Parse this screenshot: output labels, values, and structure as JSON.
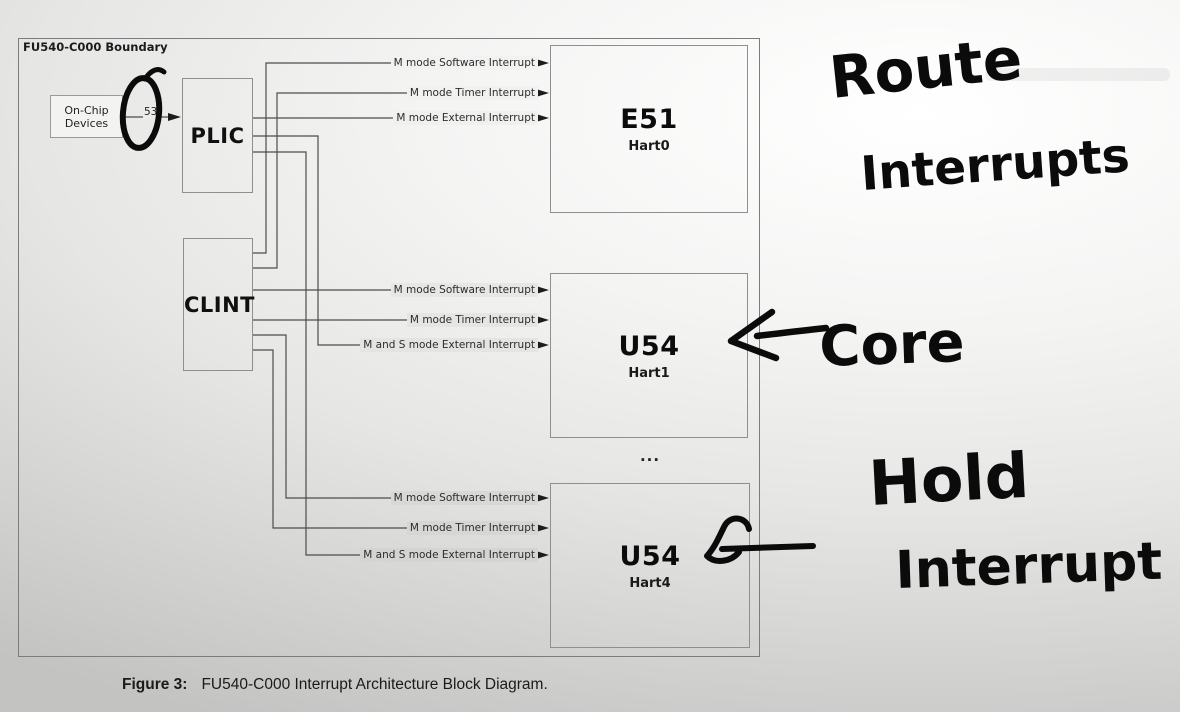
{
  "figure": {
    "boundary_label": "FU540-C000 Boundary",
    "onchip": {
      "line1": "On-Chip",
      "line2": "Devices"
    },
    "source_count": "53",
    "plic_label": "PLIC",
    "clint_label": "CLINT",
    "dots": "...",
    "cores": [
      {
        "name": "E51",
        "hart": "Hart0",
        "interrupts": [
          "M mode Software Interrupt",
          "M mode Timer Interrupt",
          "M mode External Interrupt"
        ]
      },
      {
        "name": "U54",
        "hart": "Hart1",
        "interrupts": [
          "M mode Software Interrupt",
          "M mode Timer Interrupt",
          "M and S mode External Interrupt"
        ]
      },
      {
        "name": "U54",
        "hart": "Hart4",
        "interrupts": [
          "M mode Software Interrupt",
          "M mode Timer Interrupt",
          "M and S mode External Interrupt"
        ]
      }
    ],
    "caption_label": "Figure 3:",
    "caption_text": "FU540-C000 Interrupt Architecture Block Diagram."
  },
  "annotations": {
    "route_line1": "Route",
    "route_line2": "Interrupts",
    "core": "Core",
    "hold_line1": "Hold",
    "hold_line2": "Interrupt"
  },
  "colors": {
    "ink_black": "#0b0b0b",
    "wire_gray": "#4d4d4d",
    "border_gray": "#8f8f8f",
    "background_light": "#ffffff",
    "background_dark": "#c3c3c2"
  }
}
